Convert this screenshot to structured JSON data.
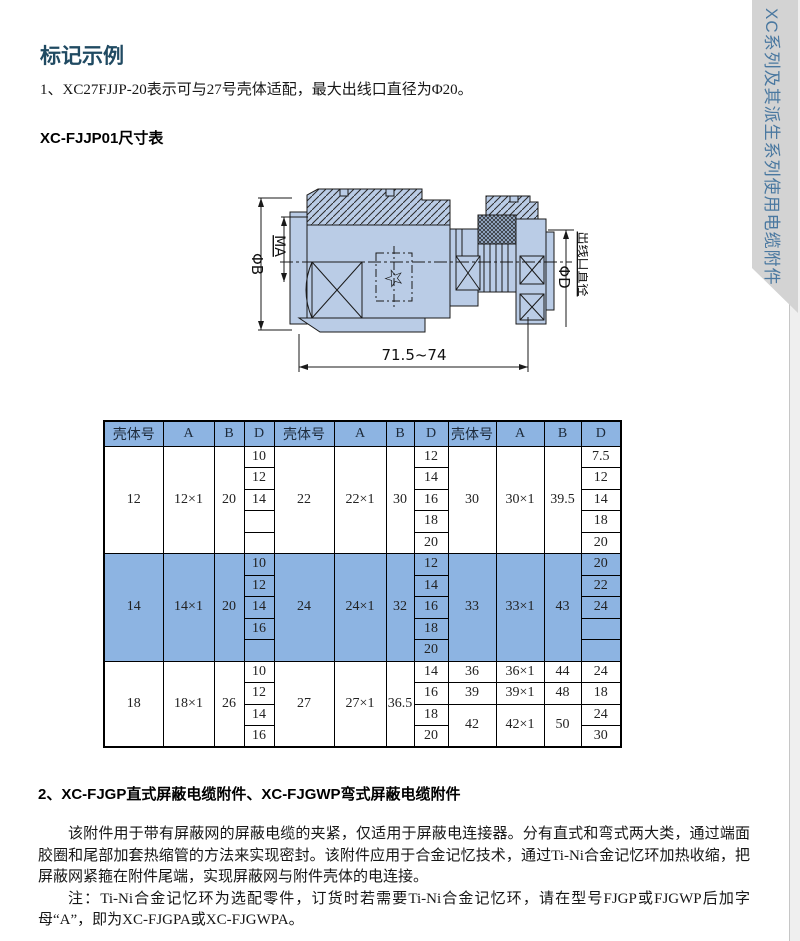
{
  "page": {
    "title": "标记示例",
    "example_note": "1、XC27FJJP-20表示可与27号壳体适配，最大出线口直径为Φ20。",
    "table_heading": "XC-FJJP01尺寸表",
    "side_tab": "XC系列及其派生系列使用电缆附件"
  },
  "drawing": {
    "dim_phi_b": "ΦB",
    "dim_ma": "MA",
    "dim_phi_d": "ΦD",
    "dim_outlet": "出线口直径",
    "dim_length": "71.5~74",
    "star": "☆"
  },
  "table": {
    "headers": [
      "壳体号",
      "A",
      "B",
      "D",
      "壳体号",
      "A",
      "B",
      "D",
      "壳体号",
      "A",
      "B",
      "D"
    ],
    "sections": [
      {
        "highlight": false,
        "rows": [
          [
            {
              "t": "12",
              "rs": 5
            },
            {
              "t": "12×1",
              "rs": 5
            },
            {
              "t": "20",
              "rs": 5
            },
            {
              "t": "10"
            },
            {
              "t": "22",
              "rs": 5
            },
            {
              "t": "22×1",
              "rs": 5
            },
            {
              "t": "30",
              "rs": 5
            },
            {
              "t": "12"
            },
            {
              "t": "30",
              "rs": 5
            },
            {
              "t": "30×1",
              "rs": 5
            },
            {
              "t": "39.5",
              "rs": 5
            },
            {
              "t": "7.5"
            }
          ],
          [
            {
              "t": "12"
            },
            {
              "t": "14"
            },
            {
              "t": "12"
            }
          ],
          [
            {
              "t": "14"
            },
            {
              "t": "16"
            },
            {
              "t": "14"
            }
          ],
          [
            {
              "t": ""
            },
            {
              "t": "18"
            },
            {
              "t": "18"
            }
          ],
          [
            {
              "t": ""
            },
            {
              "t": "20"
            },
            {
              "t": "20"
            }
          ]
        ]
      },
      {
        "highlight": true,
        "rows": [
          [
            {
              "t": "14",
              "rs": 5
            },
            {
              "t": "14×1",
              "rs": 5
            },
            {
              "t": "20",
              "rs": 5
            },
            {
              "t": "10"
            },
            {
              "t": "24",
              "rs": 5
            },
            {
              "t": "24×1",
              "rs": 5
            },
            {
              "t": "32",
              "rs": 5
            },
            {
              "t": "12"
            },
            {
              "t": "33",
              "rs": 5
            },
            {
              "t": "33×1",
              "rs": 5
            },
            {
              "t": "43",
              "rs": 5
            },
            {
              "t": "20"
            }
          ],
          [
            {
              "t": "12"
            },
            {
              "t": "14"
            },
            {
              "t": "22"
            }
          ],
          [
            {
              "t": "14"
            },
            {
              "t": "16"
            },
            {
              "t": "24"
            }
          ],
          [
            {
              "t": "16"
            },
            {
              "t": "18"
            },
            {
              "t": ""
            }
          ],
          [
            {
              "t": ""
            },
            {
              "t": "20"
            },
            {
              "t": ""
            }
          ]
        ]
      },
      {
        "highlight": false,
        "rows": [
          [
            {
              "t": "18",
              "rs": 4
            },
            {
              "t": "18×1",
              "rs": 4
            },
            {
              "t": "26",
              "rs": 4
            },
            {
              "t": "10"
            },
            {
              "t": "27",
              "rs": 4
            },
            {
              "t": "27×1",
              "rs": 4
            },
            {
              "t": "36.5",
              "rs": 4
            },
            {
              "t": "14"
            },
            {
              "t": "36"
            },
            {
              "t": "36×1"
            },
            {
              "t": "44"
            },
            {
              "t": "24"
            }
          ],
          [
            {
              "t": "12"
            },
            {
              "t": "16"
            },
            {
              "t": "39"
            },
            {
              "t": "39×1"
            },
            {
              "t": "48"
            },
            {
              "t": "18"
            }
          ],
          [
            {
              "t": "14"
            },
            {
              "t": "18"
            },
            {
              "t": "42",
              "rs": 2
            },
            {
              "t": "42×1",
              "rs": 2
            },
            {
              "t": "50",
              "rs": 2
            },
            {
              "t": "24"
            }
          ],
          [
            {
              "t": "16"
            },
            {
              "t": "20"
            },
            {
              "t": "30"
            }
          ]
        ]
      }
    ]
  },
  "section2": {
    "heading": "2、XC-FJGP直式屏蔽电缆附件、XC-FJGWP弯式屏蔽电缆附件",
    "para1": "该附件用于带有屏蔽网的屏蔽电缆的夹紧，仅适用于屏蔽电连接器。分有直式和弯式两大类，通过端面胶圈和尾部加套热缩管的方法来实现密封。该附件应用于合金记忆技术，通过Ti-Ni合金记忆环加热收缩，把屏蔽网紧箍在附件尾端，实现屏蔽网与附件壳体的电连接。",
    "para2": "注：Ti-Ni合金记忆环为选配零件，订货时若需要Ti-Ni合金记忆环，请在型号FJGP或FJGWP后加字母“A”，即为XC-FJGPA或XC-FJGWPA。"
  },
  "colors": {
    "accent_teal": "#204A62",
    "table_blue": "#8DB4E2",
    "tab_gray": "#D3D3D3",
    "tab_text": "#4A78A0",
    "draw_fill": "#BACCE6"
  }
}
